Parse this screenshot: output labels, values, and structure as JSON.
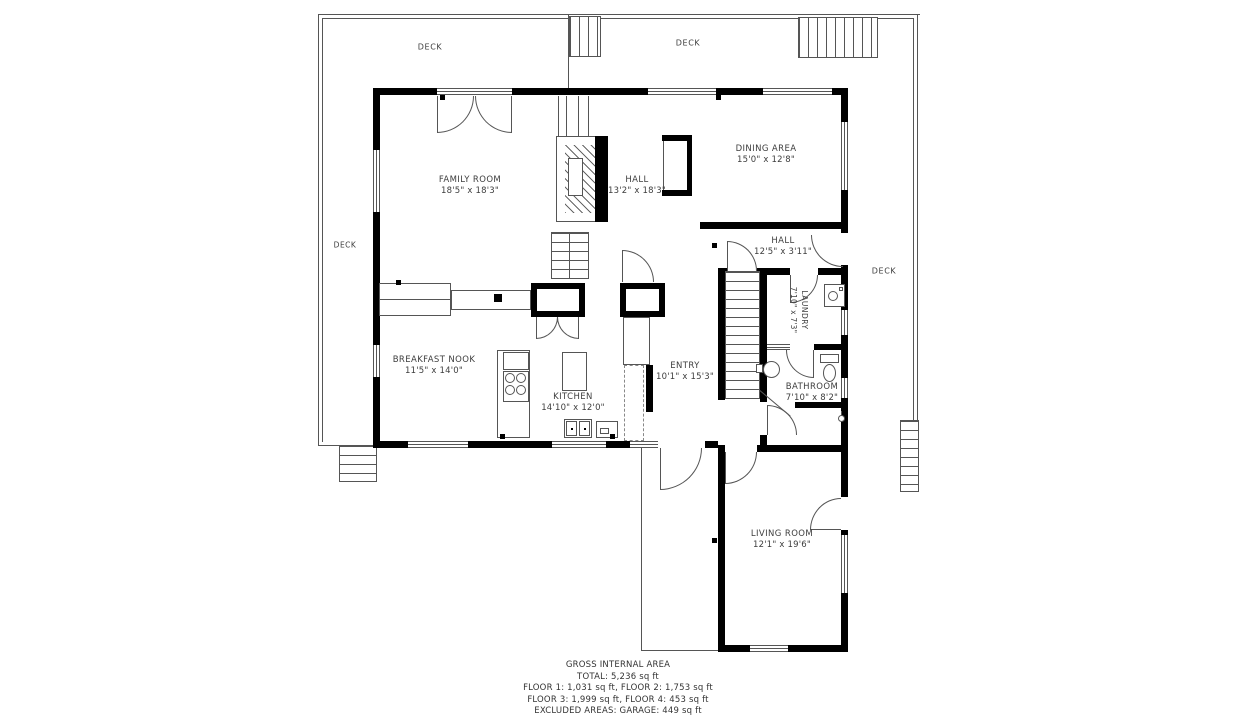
{
  "plan": {
    "rooms": [
      {
        "name": "FAMILY ROOM",
        "dims": "18'5\" x 18'3\""
      },
      {
        "name": "HALL",
        "dims": "13'2\" x 18'3\""
      },
      {
        "name": "DINING AREA",
        "dims": "15'0\" x 12'8\""
      },
      {
        "name": "HALL",
        "dims": "12'5\" x 3'11\""
      },
      {
        "name": "LAUNDRY",
        "dims": "7'10\" x 7'3\""
      },
      {
        "name": "BREAKFAST NOOK",
        "dims": "11'5\" x 14'0\""
      },
      {
        "name": "KITCHEN",
        "dims": "14'10\" x 12'0\""
      },
      {
        "name": "ENTRY",
        "dims": "10'1\" x 15'3\""
      },
      {
        "name": "BATHROOM",
        "dims": "7'10\" x 8'2\""
      },
      {
        "name": "LIVING ROOM",
        "dims": "12'1\" x 19'6\""
      }
    ],
    "decks": {
      "top_left": "DECK",
      "top_right": "DECK",
      "left": "DECK",
      "right": "DECK"
    },
    "summary": {
      "title": "GROSS INTERNAL AREA",
      "total": "TOTAL: 5,236 sq ft",
      "floors_1_2": "FLOOR 1: 1,031 sq ft, FLOOR 2: 1,753 sq ft",
      "floors_3_4": "FLOOR 3: 1,999 sq ft, FLOOR 4: 453 sq ft",
      "excluded": "EXCLUDED AREAS: GARAGE: 449 sq ft"
    },
    "colors": {
      "wall": "#000000",
      "thin_line": "#555555",
      "text": "#3d3d3d"
    }
  }
}
